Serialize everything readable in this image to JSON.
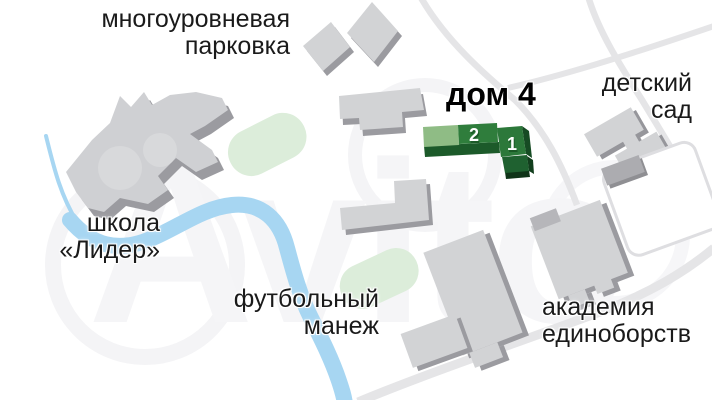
{
  "labels": {
    "parking": {
      "line1": "многоуровневая",
      "line2": "парковка"
    },
    "house4": "дом 4",
    "kindergarten": {
      "line1": "детский",
      "line2": "сад"
    },
    "school": {
      "line1": "школа",
      "line2": "«Лидер»"
    },
    "football": {
      "line1": "футбольный",
      "line2": "манеж"
    },
    "academy": {
      "line1": "академия",
      "line2": "единоборств"
    }
  },
  "house4_blocks": {
    "block1": "1",
    "block2": "2"
  },
  "watermark": "Avito",
  "colors": {
    "building_top": "#D2D3D5",
    "building_side": "#9B9BA0",
    "lawn": "#DCEDDA",
    "river": "#A7D6F2",
    "road": "#E5E5E7",
    "house_light_green": "#8FBC85",
    "house_green": "#2F7D3C",
    "house_dark_green": "#1C5A2A",
    "label_text": "#1A1A1A"
  }
}
